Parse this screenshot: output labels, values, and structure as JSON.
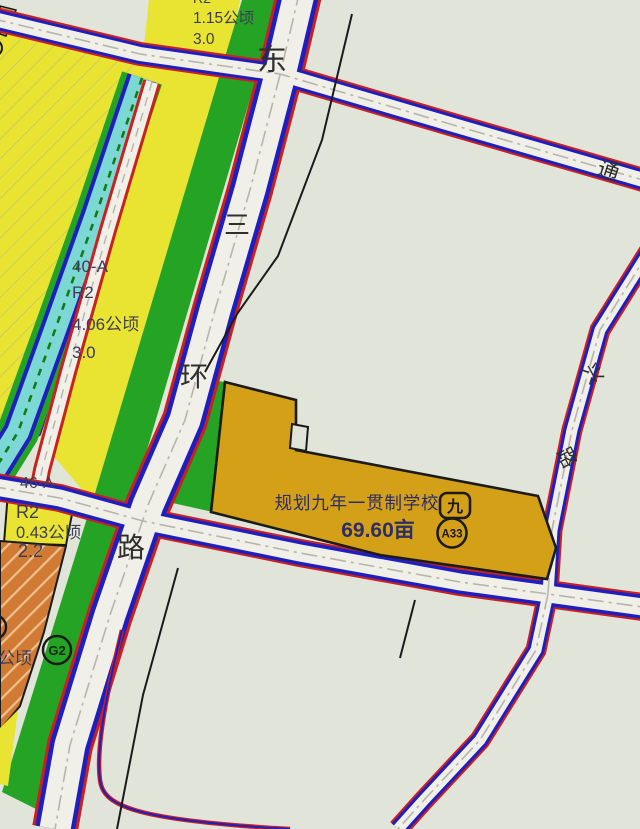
{
  "map": {
    "parcels": {
      "north_parcel": {
        "area": "1.15公顷",
        "far": "3.0",
        "partial_code": "R2"
      },
      "p40a": {
        "code": "40-A",
        "use": "R2",
        "area": "4.06公顷",
        "far": "3.0"
      },
      "p46a": {
        "code": "46-A",
        "use": "R2",
        "area": "0.43公顷",
        "far": "2.2"
      },
      "west_partial": {
        "area_suffix": "公顷"
      },
      "green_strip": {
        "badge": "G2"
      },
      "school": {
        "name": "规划九年一贯制学校",
        "area": "69.60亩",
        "block_badge": "九",
        "code_badge": "A33"
      }
    },
    "roads": {
      "east_ring": {
        "chars": [
          "东",
          "三",
          "环",
          "路"
        ]
      },
      "tongxing": {
        "chars": [
          "通",
          "兴",
          "路"
        ]
      }
    },
    "colors": {
      "background": "#e0e4d9",
      "road_surface": "#f0f0e9",
      "road_edge_red": "#c92020",
      "road_edge_blue": "#1f1fbe",
      "parcel_yellow": "#e9e432",
      "green": "#25a325",
      "canal_cyan": "#7cd8d4",
      "school_gold": "#d4a017",
      "orange": "#d07a33",
      "tan": "#c99a6b"
    }
  }
}
